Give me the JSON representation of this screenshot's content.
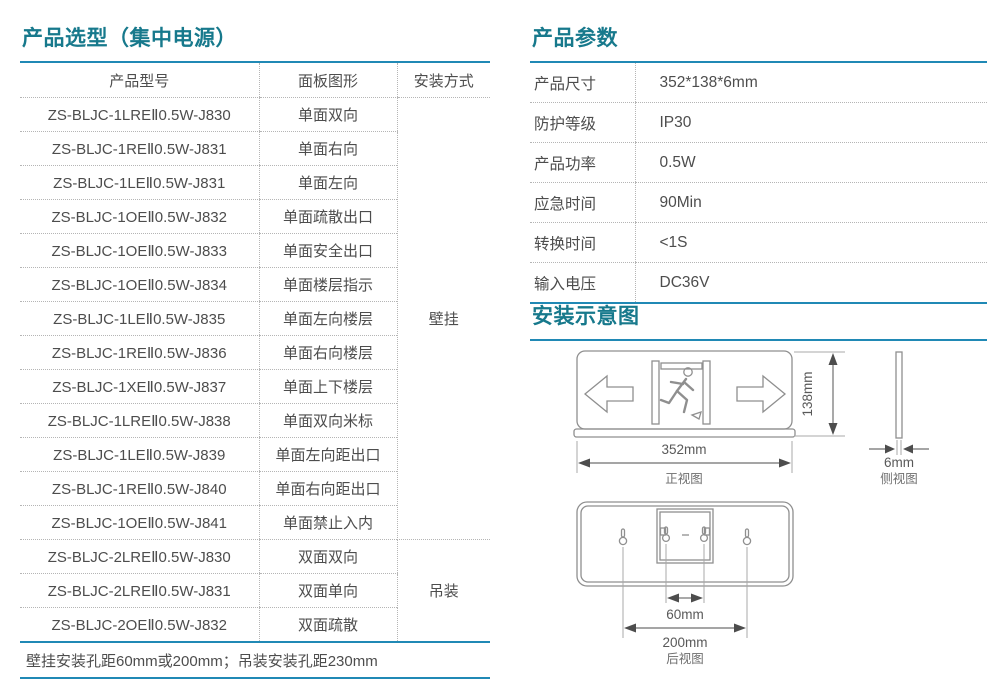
{
  "colors": {
    "accent_teal": "#17798C",
    "accent_blue": "#2089B5"
  },
  "selection": {
    "title": "产品选型（集中电源）",
    "columns": {
      "model": "产品型号",
      "panel": "面板图形",
      "mount": "安装方式"
    },
    "rows": [
      {
        "model": "ZS-BLJC-1LREⅡ0.5W-J830",
        "panel": "单面双向"
      },
      {
        "model": "ZS-BLJC-1REⅡ0.5W-J831",
        "panel": "单面右向"
      },
      {
        "model": "ZS-BLJC-1LEⅡ0.5W-J831",
        "panel": "单面左向"
      },
      {
        "model": "ZS-BLJC-1OEⅡ0.5W-J832",
        "panel": "单面疏散出口"
      },
      {
        "model": "ZS-BLJC-1OEⅡ0.5W-J833",
        "panel": "单面安全出口"
      },
      {
        "model": "ZS-BLJC-1OEⅡ0.5W-J834",
        "panel": "单面楼层指示"
      },
      {
        "model": "ZS-BLJC-1LEⅡ0.5W-J835",
        "panel": "单面左向楼层"
      },
      {
        "model": "ZS-BLJC-1REⅡ0.5W-J836",
        "panel": "单面右向楼层"
      },
      {
        "model": "ZS-BLJC-1XEⅡ0.5W-J837",
        "panel": "单面上下楼层"
      },
      {
        "model": "ZS-BLJC-1LREⅡ0.5W-J838",
        "panel": "单面双向米标"
      },
      {
        "model": "ZS-BLJC-1LEⅡ0.5W-J839",
        "panel": "单面左向距出口"
      },
      {
        "model": "ZS-BLJC-1REⅡ0.5W-J840",
        "panel": "单面右向距出口"
      },
      {
        "model": "ZS-BLJC-1OEⅡ0.5W-J841",
        "panel": "单面禁止入内"
      },
      {
        "model": "ZS-BLJC-2LREⅡ0.5W-J830",
        "panel": "双面双向"
      },
      {
        "model": "ZS-BLJC-2LREⅡ0.5W-J831",
        "panel": "双面单向"
      },
      {
        "model": "ZS-BLJC-2OEⅡ0.5W-J832",
        "panel": "双面疏散"
      }
    ],
    "mount_groups": [
      {
        "label": "壁挂",
        "row_span": 13
      },
      {
        "label": "吊装",
        "row_span": 3
      }
    ],
    "footnote": "壁挂安装孔距60mm或200mm；吊装安装孔距230mm"
  },
  "parameters": {
    "title": "产品参数",
    "rows": [
      {
        "label": "产品尺寸",
        "value": "352*138*6mm"
      },
      {
        "label": "防护等级",
        "value": "IP30"
      },
      {
        "label": "产品功率",
        "value": "0.5W"
      },
      {
        "label": "应急时间",
        "value": "90Min"
      },
      {
        "label": "转换时间",
        "value": "<1S"
      },
      {
        "label": "输入电压",
        "value": "DC36V"
      }
    ]
  },
  "installation": {
    "title": "安装示意图",
    "front_view": {
      "width_label": "352mm",
      "height_label": "138mm",
      "caption": "正视图"
    },
    "side_view": {
      "thickness_label": "6mm",
      "caption": "侧视图"
    },
    "rear_view": {
      "pitch_small": "60mm",
      "pitch_large": "200mm",
      "caption": "后视图"
    }
  }
}
